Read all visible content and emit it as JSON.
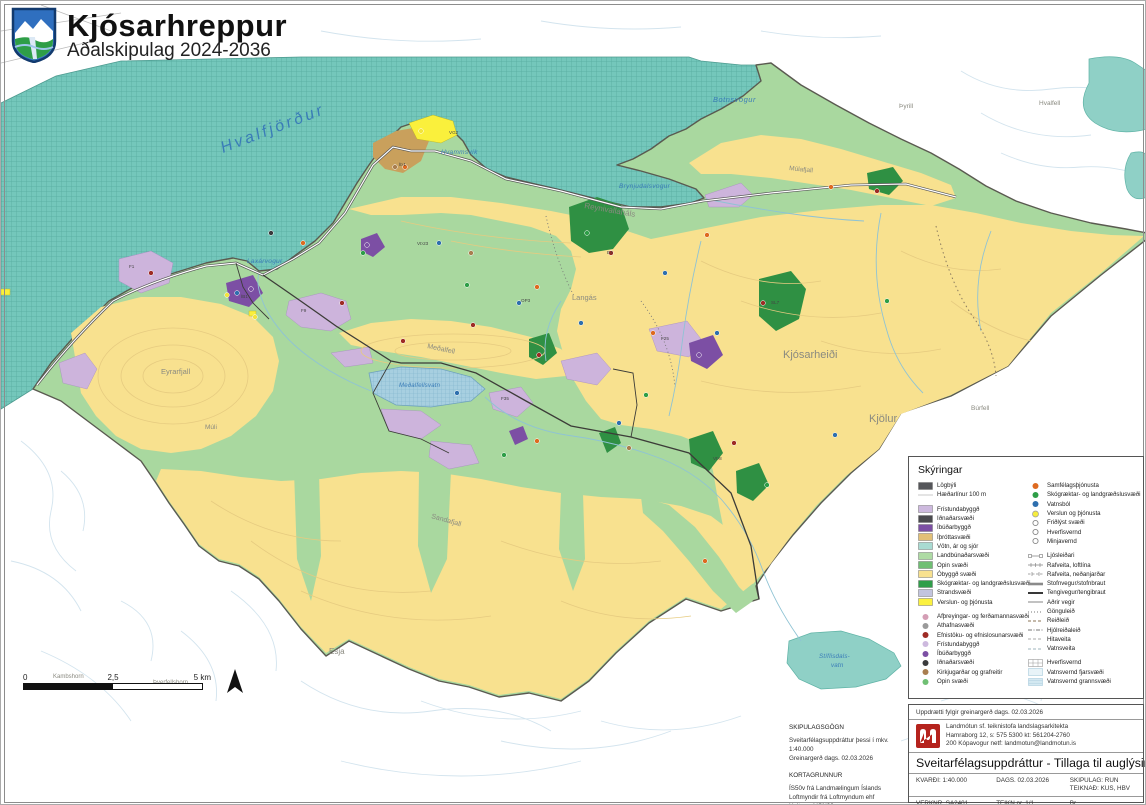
{
  "header": {
    "municipality": "Kjósarhreppur",
    "subtitle": "Aðalskipulag 2024-2036",
    "crest": "kjosarhreppur-coat-of-arms"
  },
  "colors": {
    "sea": "#74c7bb",
    "sea_grid": "#55aa9e",
    "open_water": "#8fd0c6",
    "agricultural_green": "#a9d89f",
    "uninhabited_yellow": "#f8e18f",
    "forest_green": "#2f9043",
    "leisure_lavender": "#cdb4dc",
    "residential_purple": "#7c4fa4",
    "sports_tan": "#c9a05c",
    "commerce_yellow": "#faf03c",
    "boundary": "#5a5a50",
    "water_label": "#3a7cb8",
    "terrain_label": "#8a8a80"
  },
  "map": {
    "water_labels": [
      {
        "t": "Hvalfjörður",
        "x": 222,
        "y": 152,
        "s": 16,
        "r": -21,
        "ls": 3
      },
      {
        "t": "Botnsvogur",
        "x": 712,
        "y": 101,
        "s": 7.5,
        "r": 0,
        "ls": 0.5
      },
      {
        "t": "Brynjudalsvogur",
        "x": 618,
        "y": 187,
        "s": 6.5,
        "r": 0,
        "ls": 0.3
      },
      {
        "t": "Hvammsvík",
        "x": 440,
        "y": 153,
        "s": 6.5,
        "r": 0,
        "ls": 0.3
      },
      {
        "t": "Laxárvogur",
        "x": 246,
        "y": 262,
        "s": 6.5,
        "r": 0,
        "ls": 0.3
      },
      {
        "t": "Meðalfellsvatn",
        "x": 398,
        "y": 386,
        "s": 6,
        "r": 0,
        "ls": 0.2
      },
      {
        "t": "Stíflisdals-",
        "x": 818,
        "y": 657,
        "s": 6.2,
        "r": 0,
        "ls": 0.2
      },
      {
        "t": "vatn",
        "x": 830,
        "y": 666,
        "s": 6.2,
        "r": 0,
        "ls": 0.2
      }
    ],
    "terrain_labels": [
      {
        "t": "Þyrill",
        "x": 898,
        "y": 107,
        "s": 6.5,
        "r": 0
      },
      {
        "t": "Hvalfell",
        "x": 1038,
        "y": 104,
        "s": 6.5,
        "r": 0
      },
      {
        "t": "Múlafjall",
        "x": 788,
        "y": 169,
        "s": 6.5,
        "r": 6
      },
      {
        "t": "Reynivallaháls",
        "x": 583,
        "y": 207,
        "s": 8,
        "r": 10
      },
      {
        "t": "Langás",
        "x": 571,
        "y": 299,
        "s": 7.5,
        "r": 0
      },
      {
        "t": "Kjósarheiði",
        "x": 782,
        "y": 357,
        "s": 11,
        "r": 0
      },
      {
        "t": "Kjölur",
        "x": 868,
        "y": 421,
        "s": 11,
        "r": 0
      },
      {
        "t": "Meðalfell",
        "x": 426,
        "y": 347,
        "s": 7,
        "r": 12
      },
      {
        "t": "Eyrarfjall",
        "x": 160,
        "y": 373,
        "s": 7.5,
        "r": 0
      },
      {
        "t": "Múli",
        "x": 204,
        "y": 428,
        "s": 6.5,
        "r": 0
      },
      {
        "t": "Sandafjall",
        "x": 430,
        "y": 517,
        "s": 7,
        "r": 16
      },
      {
        "t": "Esja",
        "x": 328,
        "y": 653,
        "s": 8,
        "r": 0
      },
      {
        "t": "Móskarðshnúkar",
        "x": 952,
        "y": 667,
        "s": 6.5,
        "r": 0
      },
      {
        "t": "Búrfell",
        "x": 970,
        "y": 409,
        "s": 6.5,
        "r": 0
      },
      {
        "t": "Kambshorn",
        "x": 52,
        "y": 677,
        "s": 6,
        "r": 0
      },
      {
        "t": "Þverfellshorn",
        "x": 152,
        "y": 683,
        "s": 6,
        "r": 0
      }
    ],
    "area_codes": [
      {
        "t": "F1",
        "x": 128,
        "y": 267
      },
      {
        "t": "ÍB1",
        "x": 240,
        "y": 297
      },
      {
        "t": "VÞ23",
        "x": 416,
        "y": 244
      },
      {
        "t": "F9",
        "x": 300,
        "y": 311
      },
      {
        "t": "ÍÞ1",
        "x": 398,
        "y": 165
      },
      {
        "t": "VG2",
        "x": 448,
        "y": 133
      },
      {
        "t": "F25",
        "x": 660,
        "y": 339
      },
      {
        "t": "SL7",
        "x": 770,
        "y": 303
      },
      {
        "t": "E4",
        "x": 606,
        "y": 253
      },
      {
        "t": "OP3",
        "x": 520,
        "y": 301
      },
      {
        "t": "F35",
        "x": 500,
        "y": 399
      },
      {
        "t": "VÞ8",
        "x": 712,
        "y": 459
      }
    ],
    "point_symbols": [
      {
        "x": 302,
        "y": 242,
        "c": "orange"
      },
      {
        "x": 536,
        "y": 286,
        "c": "orange"
      },
      {
        "x": 706,
        "y": 234,
        "c": "orange"
      },
      {
        "x": 830,
        "y": 186,
        "c": "orange"
      },
      {
        "x": 652,
        "y": 332,
        "c": "orange"
      },
      {
        "x": 536,
        "y": 440,
        "c": "orange"
      },
      {
        "x": 704,
        "y": 560,
        "c": "orange"
      },
      {
        "x": 404,
        "y": 166,
        "c": "orange"
      },
      {
        "x": 150,
        "y": 272,
        "c": "red"
      },
      {
        "x": 472,
        "y": 324,
        "c": "red"
      },
      {
        "x": 402,
        "y": 340,
        "c": "red"
      },
      {
        "x": 610,
        "y": 252,
        "c": "red"
      },
      {
        "x": 762,
        "y": 302,
        "c": "red"
      },
      {
        "x": 876,
        "y": 190,
        "c": "red"
      },
      {
        "x": 538,
        "y": 354,
        "c": "red"
      },
      {
        "x": 733,
        "y": 442,
        "c": "red"
      },
      {
        "x": 341,
        "y": 302,
        "c": "red"
      },
      {
        "x": 236,
        "y": 292,
        "c": "blue"
      },
      {
        "x": 438,
        "y": 242,
        "c": "blue"
      },
      {
        "x": 518,
        "y": 302,
        "c": "blue"
      },
      {
        "x": 664,
        "y": 272,
        "c": "blue"
      },
      {
        "x": 716,
        "y": 332,
        "c": "blue"
      },
      {
        "x": 456,
        "y": 392,
        "c": "blue"
      },
      {
        "x": 618,
        "y": 422,
        "c": "blue"
      },
      {
        "x": 834,
        "y": 434,
        "c": "blue"
      },
      {
        "x": 580,
        "y": 322,
        "c": "blue"
      },
      {
        "x": 362,
        "y": 252,
        "c": "green"
      },
      {
        "x": 466,
        "y": 284,
        "c": "green"
      },
      {
        "x": 586,
        "y": 232,
        "c": "green"
      },
      {
        "x": 645,
        "y": 394,
        "c": "green"
      },
      {
        "x": 503,
        "y": 454,
        "c": "green"
      },
      {
        "x": 766,
        "y": 484,
        "c": "green"
      },
      {
        "x": 886,
        "y": 300,
        "c": "green"
      },
      {
        "x": 226,
        "y": 294,
        "c": "yellow"
      },
      {
        "x": 420,
        "y": 130,
        "c": "yellow"
      },
      {
        "x": 254,
        "y": 316,
        "c": "yellow"
      },
      {
        "x": 250,
        "y": 288,
        "c": "purple"
      },
      {
        "x": 366,
        "y": 244,
        "c": "purple"
      },
      {
        "x": 698,
        "y": 354,
        "c": "purple"
      },
      {
        "x": 394,
        "y": 166,
        "c": "brown"
      },
      {
        "x": 470,
        "y": 252,
        "c": "brown"
      },
      {
        "x": 628,
        "y": 447,
        "c": "brown"
      },
      {
        "x": 270,
        "y": 232,
        "c": "black"
      }
    ],
    "symbol_colors": {
      "orange": "#de6a20",
      "red": "#9e2b25",
      "blue": "#2e6fae",
      "green": "#2e9e47",
      "yellow": "#f2e43c",
      "purple": "#7c4fa4",
      "brown": "#a97e4f",
      "black": "#3a3a3c",
      "pink": "#d49eb5",
      "gray": "#9a9a9a"
    }
  },
  "legend": {
    "title": "Skýringar",
    "left": [
      {
        "label": "Lögbýli",
        "type": "swatch",
        "color": "#55565a"
      },
      {
        "label": "Hæðarlínur 100 m",
        "type": "line",
        "color": "#bcbcbc",
        "w": 0.8
      },
      {
        "label": "Frístundabyggð",
        "type": "swatch",
        "color": "#cdb9de",
        "gap": true
      },
      {
        "label": "Iðnaðarsvæði",
        "type": "swatch",
        "color": "#4a4a4e"
      },
      {
        "label": "Íbúðarbyggð",
        "type": "swatch",
        "color": "#7c4fa4"
      },
      {
        "label": "Íþróttasvæði",
        "type": "swatch",
        "color": "#e2c077"
      },
      {
        "label": "Vötn, ár og sjór",
        "type": "swatch",
        "color": "#a9dbd2"
      },
      {
        "label": "Landbúnaðarsvæði",
        "type": "swatch",
        "color": "#aedba4"
      },
      {
        "label": "Opin svæði",
        "type": "swatch",
        "color": "#6fbf73"
      },
      {
        "label": "Óbyggð svæði",
        "type": "swatch",
        "color": "#f8e18f"
      },
      {
        "label": "Skógræktar- og landgræðslusvæði",
        "type": "swatch",
        "color": "#2f9e49"
      },
      {
        "label": "Strandsvæði",
        "type": "swatch",
        "color": "#c2c4de"
      },
      {
        "label": "Verslun- og þjónusta",
        "type": "swatch",
        "color": "#fbf13f"
      },
      {
        "label": "Afþreyingar- og ferðamannasvæði",
        "type": "dot",
        "color": "#d49eb5",
        "gap": true
      },
      {
        "label": "Athafnasvæði",
        "type": "dot",
        "color": "#9a9a9a"
      },
      {
        "label": "Efnistöku- og efnislosunarsvæði",
        "type": "dot",
        "color": "#9e2b25"
      },
      {
        "label": "Frístundabyggð",
        "type": "dot",
        "color": "#cdb9de"
      },
      {
        "label": "Íbúðarbyggð",
        "type": "dot",
        "color": "#7c4fa4"
      },
      {
        "label": "Iðnaðarsvæði",
        "type": "dot",
        "color": "#3a3a3c"
      },
      {
        "label": "Kirkjugarðar og grafreitir",
        "type": "dot",
        "color": "#a97e4f"
      },
      {
        "label": "Opin svæði",
        "type": "dot",
        "color": "#6fbf73"
      }
    ],
    "right": [
      {
        "label": "Samfélagsþjónusta",
        "type": "dot",
        "color": "#de6a20"
      },
      {
        "label": "Skógræktar- og landgræðslusvæði",
        "type": "dot",
        "color": "#2e9e47"
      },
      {
        "label": "Vatnsból",
        "type": "dot",
        "color": "#2e6fae"
      },
      {
        "label": "Verslun og þjónusta",
        "type": "dot-ring",
        "color": "#f5ec3d"
      },
      {
        "label": "Friðlýst svæði",
        "type": "ring",
        "color": "#888888"
      },
      {
        "label": "Hverfisvernd",
        "type": "ring",
        "color": "#888888"
      },
      {
        "label": "Minjavernd",
        "type": "ring",
        "color": "#888888"
      },
      {
        "label": "Ljósleiðari",
        "type": "line-squares",
        "color": "#8a8a8a",
        "gap": true
      },
      {
        "label": "Rafveita, loftlína",
        "type": "line-ticks",
        "color": "#8a8a8a"
      },
      {
        "label": "Rafveita, neðanjarðar",
        "type": "line-ticks-dash",
        "color": "#8a8a8a"
      },
      {
        "label": "Stofnvegur/stofnbraut",
        "type": "line",
        "color": "#8a8a8a",
        "w": 2.6
      },
      {
        "label": "Tengivegur/tengibraut",
        "type": "line",
        "color": "#222222",
        "w": 1.8
      },
      {
        "label": "Aðrir vegir",
        "type": "line",
        "color": "#9a9a9a",
        "w": 1.2
      },
      {
        "label": "Gönguleið",
        "type": "dotted",
        "color": "#777777"
      },
      {
        "label": "Reiðleið",
        "type": "dashed",
        "color": "#8b7355"
      },
      {
        "label": "Hjólreiðaleið",
        "type": "dashdot",
        "color": "#777777"
      },
      {
        "label": "Hitaveita",
        "type": "dashed",
        "color": "#aaaaaa"
      },
      {
        "label": "Vatnsveita",
        "type": "dashed",
        "color": "#9fb6be"
      },
      {
        "label": "Hverfisvernd",
        "type": "box-hatch",
        "color": "#999999",
        "gap": true
      },
      {
        "label": "Vatnsvernd fjarsvæði",
        "type": "box",
        "color": "#e8f3f8",
        "border": "#a9cbdc"
      },
      {
        "label": "Vatnsvernd grannsvæði",
        "type": "box-lines",
        "color": "#d5e9f2",
        "border": "#a9cbdc"
      }
    ]
  },
  "scalebar": {
    "start": "0",
    "mid": "2,5",
    "end": "5 km"
  },
  "notes": {
    "sec1_title": "SKIPULAGSGÖGN",
    "sec1_line1": "Sveitarfélagsuppdráttur þessi í mkv. 1:40.000",
    "sec1_line2": "Greinargerð dags. 02.03.2026",
    "sec2_title": "KORTAGRUNNUR",
    "sec2_line1": "ÍS50v frá Landmælingum Íslands",
    "sec2_line2": "Loftmyndir frá Loftmyndum ehf",
    "sec2_line3": "Hnit eru í ISN93"
  },
  "titleblock": {
    "note": "Uppdrætti fylgir greinargerð dags. 02.03.2026",
    "firm_line1": "Landmótun sf. teiknistofa landslagsarkitekta",
    "firm_line2": "Hamraborg 12,   s: 575 5300   kt: 561204-2760",
    "firm_line3": "200 Kópavogur   netf: landmotun@landmotun.is",
    "main_title": "Sveitarfélagsuppdráttur - Tillaga til auglýsingar",
    "scale": "KVARÐI: 1:40.000",
    "date": "DAGS. 02.03.2026",
    "plan_by": "SKIPULAG: RUN",
    "drawn_by": "TEIKNAÐ: KUS, HBV",
    "project_no": "VERKNR. SA2401",
    "sheet": "TEIKN nr. 1/1",
    "revision": "Br."
  }
}
